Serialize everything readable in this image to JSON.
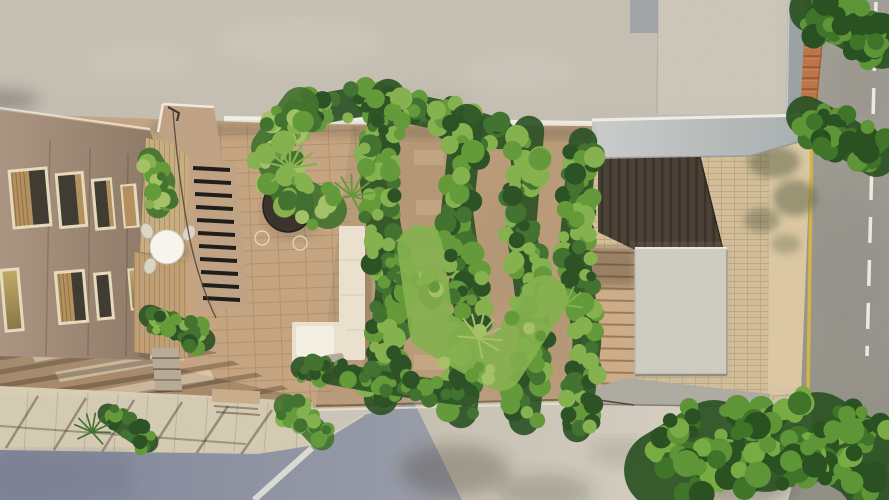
{
  "meta": {
    "title": "Aerial top-down architectural rendering - courtyard garden between buildings",
    "view": "top-down site plan render",
    "width": 889,
    "height": 500
  },
  "colors": {
    "wall": "#c8c2b5",
    "wall_light": "#d7d1c3",
    "white_strip": "#f1eee5",
    "canopy_edge": "#edebe4",
    "shade_dark": "#4a4237",
    "slat": "#362e26",
    "brick": "#d3bf99",
    "beige_strip": "#dbc8a3",
    "yellow_line": "#d8b643",
    "dash_white": "#eaeae3",
    "parapet": "#9aa0a4",
    "terracotta": "#bf7143",
    "terracotta_dark": "#98562e",
    "courtyard_paving": "#c5a581",
    "garden_soil": "#b99b79",
    "sidewalk_left": "#d7cdb4",
    "street_shadow": "#8b90a2",
    "curb_white": "#e8e5db",
    "plaza": "#cdc7ba",
    "gray_band": "#aeaba2",
    "right_steps": "#cdad89",
    "pad": "#d2d0c4",
    "stair_base": "#c0a284",
    "tread_dark": "#1f1e1b",
    "wood_siding": "#c7ad80",
    "deck": "#c19f74",
    "window_frame": "#e6dabc",
    "shutter_wood": "#b3905e",
    "window_dark": "#413c31",
    "glass_olive": "#b4a166",
    "table_white": "#f6f4ed",
    "chair": "#dcd5c5",
    "sofa": "#e9e1cd",
    "cushion": "#f3efe2",
    "pillow": "#b3aa98",
    "pot_dark": "#3a342c",
    "bench": "#c9ad8a",
    "stone_step": "#b7ab97",
    "shadow": "#3c3122",
    "green_dark": "#2d5226",
    "green_mid": "#437330",
    "green_bright": "#659a3a",
    "green_light": "#85b14f",
    "green_pale": "#a4c167",
    "tree_dark": "#2a5122",
    "tree_mid": "#3f7429",
    "tree_light": "#5d9537",
    "tree_pale": "#79ab45"
  },
  "scene": {
    "elements": [
      "upper concrete roof slab",
      "left apartment facade with shuttered windows",
      "entry canopy",
      "courtyard wood deck with round table",
      "black-tread staircase",
      "four vertical hedge rows",
      "cream lounge sofa",
      "dark round planter table",
      "right stair flight to street",
      "concrete pad",
      "brick sidewalk",
      "asphalt road",
      "street trees",
      "shaded street at bottom left"
    ],
    "foliage_bands": [
      {
        "name": "top-hedge",
        "seed": 11,
        "pts": [
          [
            298,
            113
          ],
          [
            368,
            100
          ],
          [
            436,
            114
          ],
          [
            500,
            134
          ]
        ],
        "w": 16,
        "n": 70,
        "r": [
          5,
          11
        ],
        "shades": [
          "green_dark",
          "green_mid",
          "green_bright",
          "green_light"
        ]
      },
      {
        "name": "hedge-1",
        "seed": 22,
        "pts": [
          [
            388,
            96
          ],
          [
            377,
            182
          ],
          [
            393,
            285
          ],
          [
            381,
            398
          ]
        ],
        "w": 18,
        "n": 115,
        "r": [
          5,
          12
        ],
        "shades": [
          "green_dark",
          "green_mid",
          "green_bright",
          "green_light"
        ]
      },
      {
        "name": "hedge-2",
        "seed": 33,
        "pts": [
          [
            467,
            120
          ],
          [
            457,
            213
          ],
          [
            471,
            315
          ],
          [
            461,
            412
          ]
        ],
        "w": 17,
        "n": 108,
        "r": [
          5,
          12
        ],
        "shades": [
          "green_dark",
          "green_mid",
          "green_bright",
          "green_light"
        ]
      },
      {
        "name": "hedge-3",
        "seed": 44,
        "pts": [
          [
            529,
            131
          ],
          [
            521,
            227
          ],
          [
            535,
            330
          ],
          [
            524,
            420
          ]
        ],
        "w": 16,
        "n": 100,
        "r": [
          5,
          12
        ],
        "shades": [
          "green_dark",
          "green_mid",
          "green_bright",
          "green_light"
        ]
      },
      {
        "name": "hedge-4",
        "seed": 55,
        "pts": [
          [
            583,
            142
          ],
          [
            574,
            240
          ],
          [
            587,
            342
          ],
          [
            577,
            428
          ]
        ],
        "w": 15,
        "n": 95,
        "r": [
          5,
          11
        ],
        "shades": [
          "green_dark",
          "green_mid",
          "green_bright",
          "green_light"
        ]
      },
      {
        "name": "corner-palms",
        "seed": 66,
        "pts": [
          [
            300,
            106
          ],
          [
            270,
            148
          ],
          [
            290,
            192
          ],
          [
            328,
            210
          ]
        ],
        "w": 20,
        "n": 55,
        "r": [
          5,
          12
        ],
        "shades": [
          "green_mid",
          "green_bright",
          "green_light",
          "green_pale"
        ]
      },
      {
        "name": "shrub-row",
        "seed": 77,
        "pts": [
          [
            302,
            368
          ],
          [
            368,
            380
          ],
          [
            438,
            391
          ],
          [
            468,
            395
          ]
        ],
        "w": 12,
        "n": 48,
        "r": [
          4,
          9
        ],
        "shades": [
          "green_dark",
          "green_mid",
          "green_bright"
        ]
      },
      {
        "name": "planter-deck",
        "seed": 88,
        "pts": [
          [
            150,
            316
          ],
          [
            178,
            328
          ],
          [
            204,
            340
          ]
        ],
        "w": 12,
        "n": 30,
        "r": [
          4,
          9
        ],
        "shades": [
          "green_dark",
          "green_mid",
          "green_bright",
          "green_light"
        ]
      },
      {
        "name": "stair-plant",
        "seed": 99,
        "pts": [
          [
            150,
            160
          ],
          [
            163,
            182
          ],
          [
            158,
            206
          ]
        ],
        "w": 13,
        "n": 26,
        "r": [
          4,
          9
        ],
        "shades": [
          "green_mid",
          "green_bright",
          "green_light",
          "green_pale"
        ]
      },
      {
        "name": "street-plant-left",
        "seed": 111,
        "pts": [
          [
            108,
            414
          ],
          [
            128,
            428
          ],
          [
            148,
            442
          ]
        ],
        "w": 11,
        "n": 20,
        "r": [
          4,
          8
        ],
        "shades": [
          "green_dark",
          "green_mid",
          "green_bright"
        ]
      },
      {
        "name": "street-plant-mid",
        "seed": 122,
        "pts": [
          [
            286,
            406
          ],
          [
            305,
            420
          ],
          [
            322,
            438
          ]
        ],
        "w": 13,
        "n": 26,
        "r": [
          4,
          9
        ],
        "shades": [
          "green_mid",
          "green_bright",
          "green_light"
        ]
      },
      {
        "name": "path-plants",
        "seed": 133,
        "pts": [
          [
            420,
            248
          ],
          [
            432,
            330
          ],
          [
            500,
            368
          ],
          [
            545,
            298
          ]
        ],
        "w": 24,
        "n": 16,
        "r": [
          4,
          8
        ],
        "shades": [
          "green_light",
          "green_pale",
          "green_bright"
        ]
      },
      {
        "name": "tree-top-right-1",
        "seed": 144,
        "pts": [
          [
            812,
            10
          ],
          [
            846,
            25
          ],
          [
            882,
            46
          ]
        ],
        "w": 24,
        "n": 48,
        "r": [
          6,
          13
        ],
        "shades": [
          "tree_dark",
          "tree_mid",
          "tree_light"
        ]
      },
      {
        "name": "tree-top-right-2",
        "seed": 155,
        "pts": [
          [
            806,
            116
          ],
          [
            840,
            134
          ],
          [
            876,
            157
          ]
        ],
        "w": 21,
        "n": 40,
        "r": [
          6,
          12
        ],
        "shades": [
          "tree_dark",
          "tree_mid",
          "tree_light"
        ]
      },
      {
        "name": "tree-bottom-right",
        "seed": 166,
        "pts": [
          [
            664,
            470
          ],
          [
            714,
            440
          ],
          [
            766,
            452
          ],
          [
            818,
            432
          ],
          [
            868,
            462
          ],
          [
            884,
            482
          ]
        ],
        "w": 42,
        "n": 160,
        "r": [
          6,
          14
        ],
        "shades": [
          "tree_dark",
          "tree_mid",
          "tree_light",
          "tree_pale"
        ]
      }
    ]
  }
}
